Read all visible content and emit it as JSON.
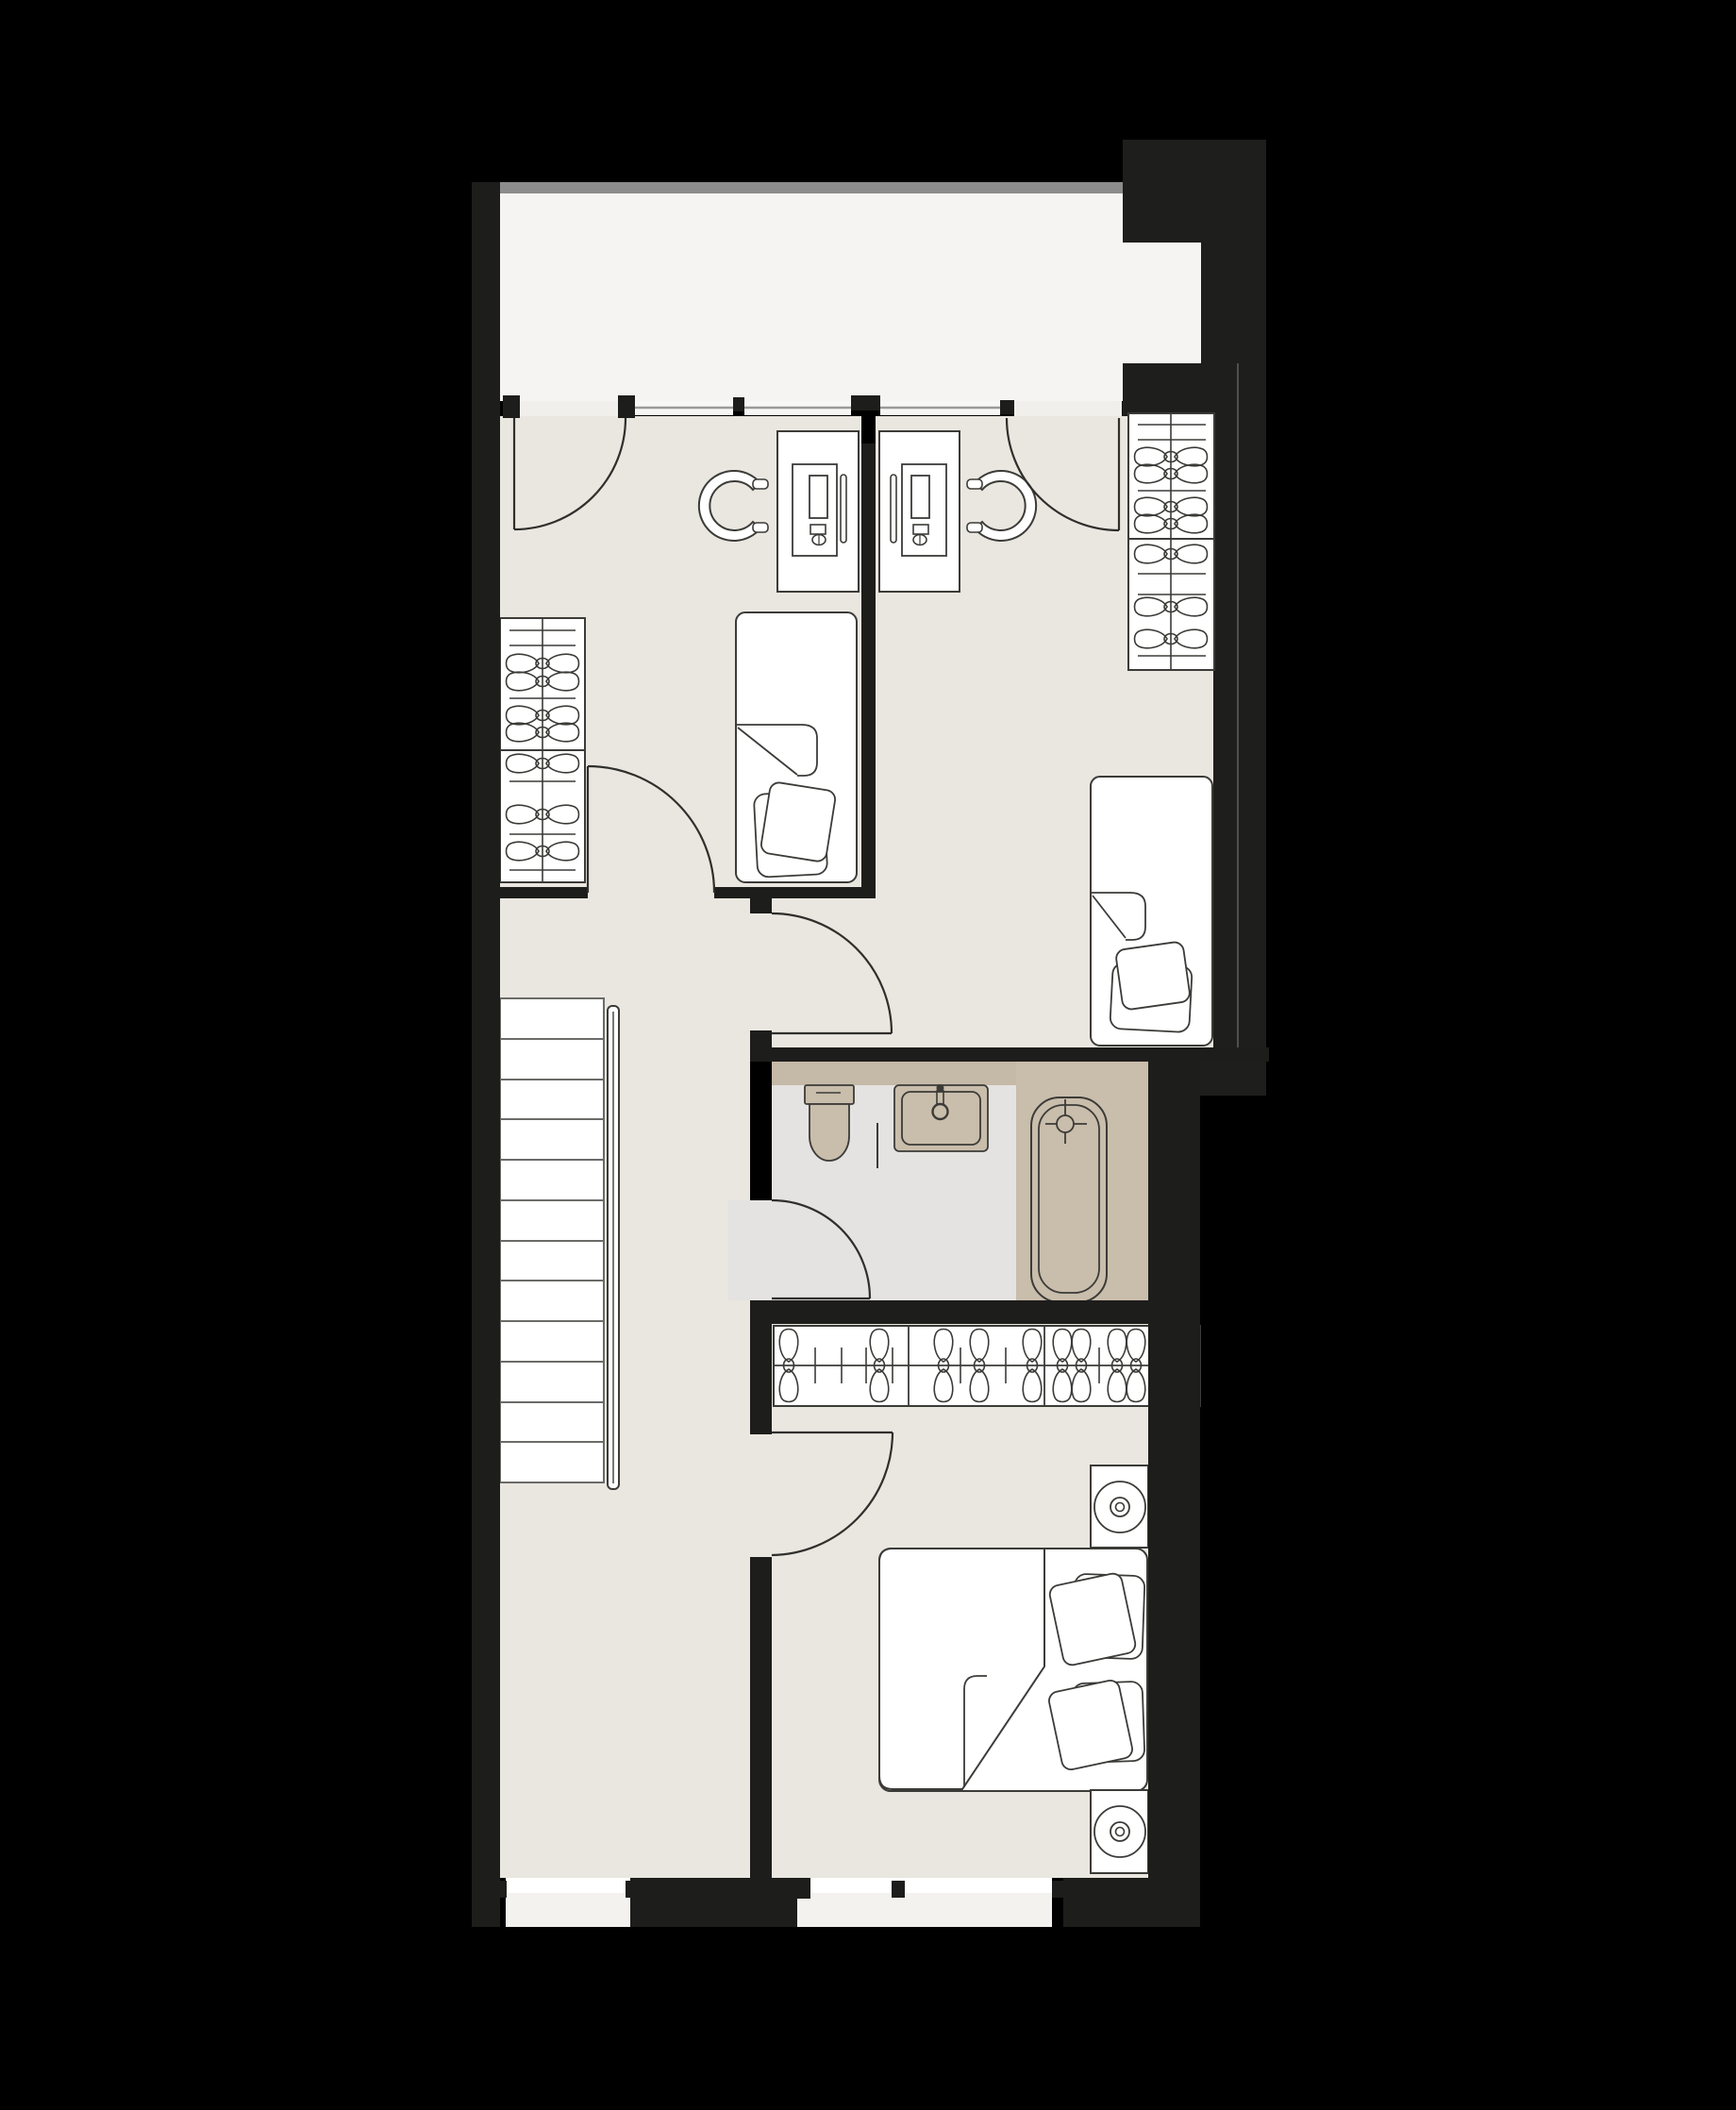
{
  "colors": {
    "bg": "#000000",
    "wall": "#1d1d1b",
    "mass": "#1e1e1c",
    "parapet": "#8c8c8c",
    "terrace_floor": "#f5f4f2",
    "room_floor": "#eae6e0",
    "bath_floor": "#e4e3e1",
    "counter": "#c5b9a7",
    "fixture": "#c9bdab",
    "furniture_fill": "#ffffff",
    "line": "#2f2f2c",
    "furn_line": "#3b3b38",
    "glaze_band": "#f7f7f5",
    "glaze_line": "#9a9a98",
    "faint_line": "#4f4f4c",
    "tread_line": "#6b6b68",
    "window_sill": "#f3f2ef",
    "window_top": "#ffffff",
    "threshold": "#f1efec"
  },
  "plan": {
    "type": "apartment-upper-floor-plan",
    "rooms": [
      {
        "name": "terrace",
        "items": [
          "terrace-floor",
          "parapet-edge"
        ]
      },
      {
        "name": "bedroom-left",
        "items": [
          "terrace-door",
          "desk",
          "desk-chair",
          "monitor",
          "single-bed",
          "pillows",
          "wardrobe-hangers",
          "room-door"
        ]
      },
      {
        "name": "bedroom-right",
        "items": [
          "terrace-door",
          "desk",
          "desk-chair",
          "monitor",
          "single-bed",
          "pillows",
          "wardrobe-hangers",
          "room-door"
        ]
      },
      {
        "name": "hallway",
        "items": [
          "staircase",
          "handrail",
          "window"
        ]
      },
      {
        "name": "bathroom",
        "items": [
          "toilet",
          "washbasin",
          "faucet",
          "bathtub",
          "towel-rail",
          "bathroom-door"
        ]
      },
      {
        "name": "bedroom-bottom",
        "items": [
          "closet-rail-hangers",
          "double-bed",
          "pillows",
          "nightstand",
          "lamp",
          "nightstand",
          "lamp",
          "room-door",
          "window"
        ]
      }
    ],
    "counts": {
      "doors": 6,
      "beds": 3,
      "desks": 2,
      "chairs": 2,
      "wardrobes": 2,
      "nightstands": 2,
      "lamps": 2,
      "windows": 3
    }
  }
}
